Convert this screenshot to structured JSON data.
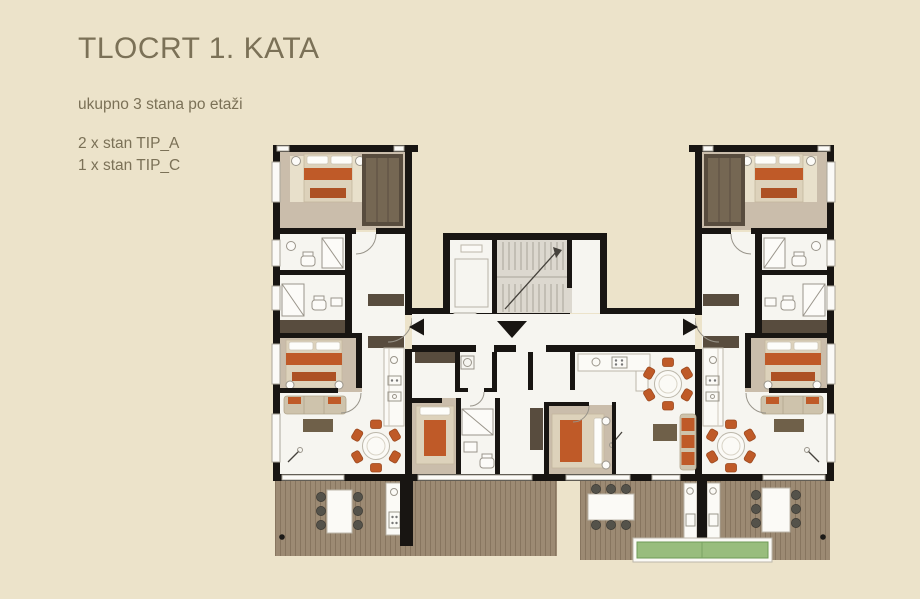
{
  "header": {
    "title": "TLOCRT 1. KATA",
    "subtitle": "ukupno 3 stana po etaži",
    "unit_lines": [
      "2 x stan TIP_A",
      "1 x stan TIP_C"
    ]
  },
  "plan": {
    "apartments_per_floor": 3,
    "types": [
      {
        "type": "TIP_A",
        "count": 2
      },
      {
        "type": "TIP_C",
        "count": 1
      }
    ],
    "icons": [
      "entrance-arrow-left-icon",
      "entrance-arrow-down-icon",
      "entrance-arrow-right-icon",
      "staircase-icon",
      "elevator-icon"
    ]
  },
  "colors": {
    "background": "#ece3ca",
    "text": "#7b7157",
    "wall": "#181512",
    "room": "#f6f5f0",
    "bedroom_floor": "#cabdab",
    "rug_light": "#e8e0cb",
    "bed_cream": "#ddd2bb",
    "wardrobe": "#584c3e",
    "orange": "#bf5a28",
    "orange_dark": "#ad5124",
    "sofa_tan": "#cec3ac",
    "rug_dark": "#6f6049",
    "deck": "#9c8a73",
    "deck_line": "#87755f",
    "planter": "#98bd7d",
    "outdoor_chair": "#54524a",
    "stair_fill": "#dcd8cf",
    "fixture_line": "#9a958b"
  }
}
